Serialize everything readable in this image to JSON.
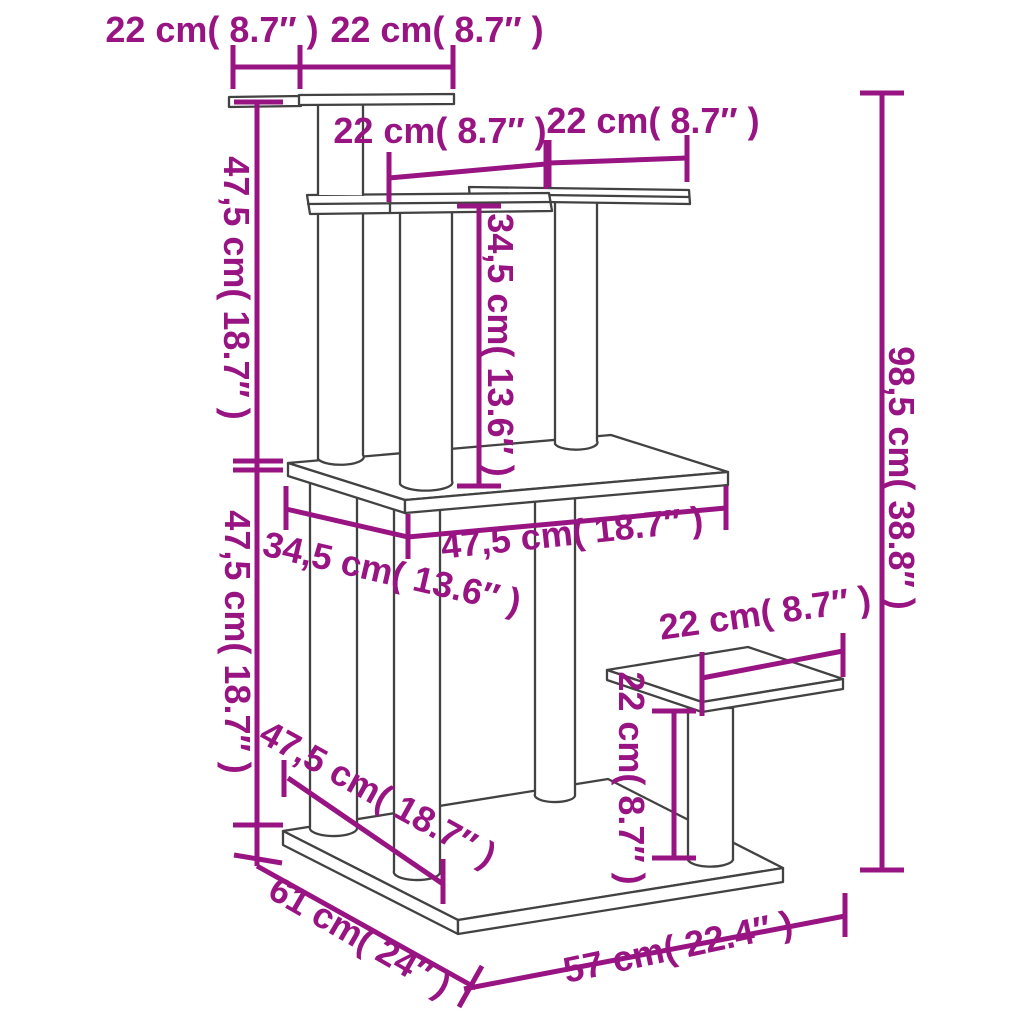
{
  "diagram": {
    "type": "product-dimension-line-drawing",
    "subject": "cat tree with platforms and scratching posts",
    "colors": {
      "dimension_lines": "#991483",
      "structure_lines": "#424242",
      "background": "#ffffff"
    },
    "labels": {
      "top_width_left": "22 cm( 8.7″ )",
      "top_width_right": "22 cm( 8.7″ )",
      "shelf_width_left": "22 cm( 8.7″ )",
      "shelf_width_right": "22 cm( 8.7″ )",
      "height_upper": "47,5 cm( 18.7″ )",
      "height_lower": "47,5 cm( 18.7″ )",
      "shelf_to_platform_height": "34,5 cm( 13.6″ )",
      "total_height": "98,5 cm( 38.8″ )",
      "platform_width": "47,5 cm( 18.7″ )",
      "platform_depth": "34,5 cm( 13.6″ )",
      "base_inner_diagonal": "47,5 cm( 18.7″ )",
      "step_width": "22 cm( 8.7″ )",
      "step_height": "22 cm( 8.7″ )",
      "base_depth": "61 cm( 24″ )",
      "base_width": "57 cm( 22.4″ )"
    }
  }
}
